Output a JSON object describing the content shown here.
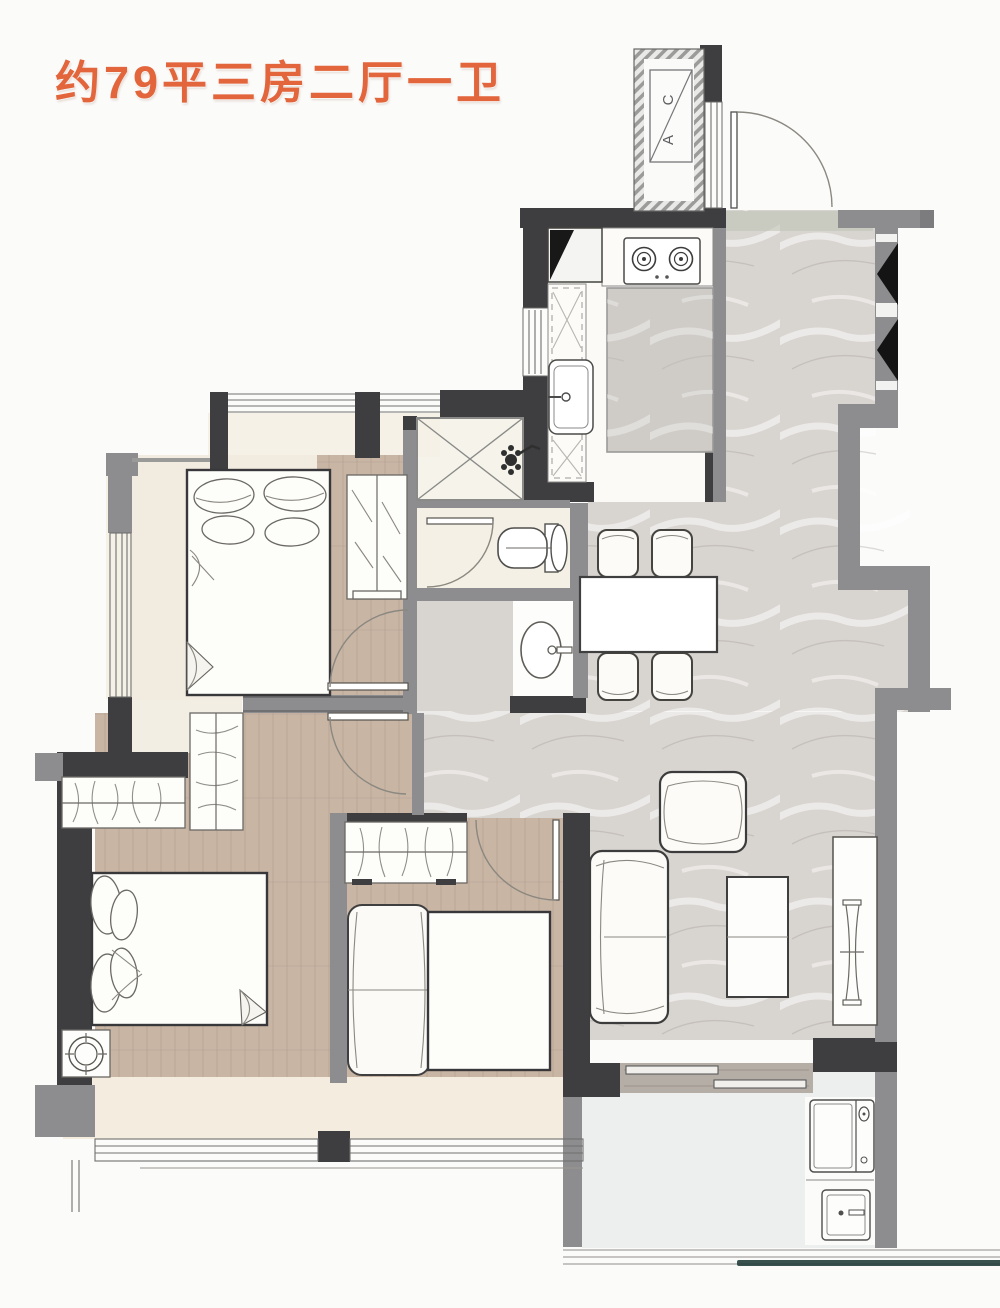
{
  "title": {
    "text": "约79平三房二厅一卫"
  },
  "section_marker": {
    "top_label": "C",
    "bottom_label": "A"
  },
  "colors": {
    "accent": "#e2653c",
    "wall_dark": "#3e3e41",
    "wall_gray": "#8d8d8f",
    "marble": "#d8d4d0",
    "wood": "#c8b5a4",
    "cream": "#f2ebdf",
    "floor_balcony": "#edefef",
    "rail_teal": "#233f3c"
  }
}
